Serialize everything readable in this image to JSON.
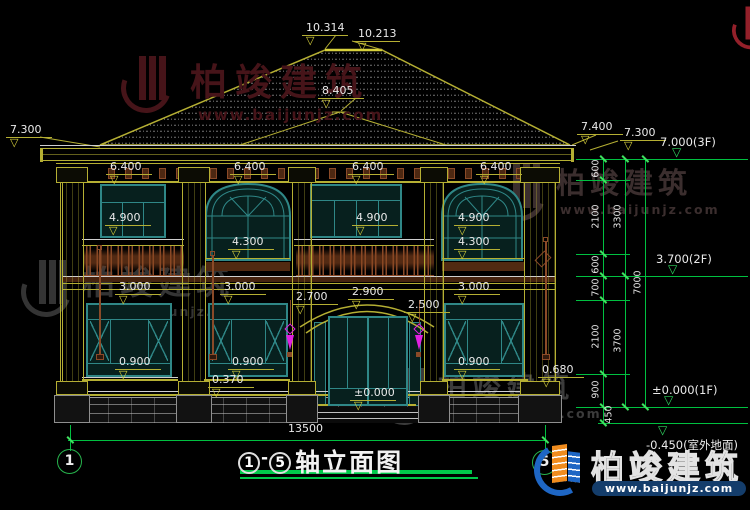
{
  "brand": {
    "name": "柏竣建筑",
    "url": "www.baijunjz.com"
  },
  "title": {
    "axis_from": "1",
    "dash": "-",
    "axis_to": "5",
    "text": "轴立面图"
  },
  "grid_bubbles": {
    "left": "1",
    "right": "5"
  },
  "overall_dim": {
    "text": "13500"
  },
  "icons": {
    "level_triangle": "▽"
  },
  "elevation_labels": [
    {
      "text": "10.314",
      "x": 302,
      "y": 22
    },
    {
      "text": "10.213",
      "x": 354,
      "y": 28
    },
    {
      "text": "8.405",
      "x": 318,
      "y": 85
    },
    {
      "text": "7.300",
      "x": 6,
      "y": 124
    },
    {
      "text": "7.400",
      "x": 577,
      "y": 121
    },
    {
      "text": "7.300",
      "x": 620,
      "y": 127
    },
    {
      "text": "6.400",
      "x": 106,
      "y": 161
    },
    {
      "text": "6.400",
      "x": 230,
      "y": 161
    },
    {
      "text": "6.400",
      "x": 348,
      "y": 161
    },
    {
      "text": "6.400",
      "x": 476,
      "y": 161
    },
    {
      "text": "4.900",
      "x": 105,
      "y": 212
    },
    {
      "text": "4.900",
      "x": 352,
      "y": 212
    },
    {
      "text": "4.900",
      "x": 454,
      "y": 212
    },
    {
      "text": "4.300",
      "x": 228,
      "y": 236
    },
    {
      "text": "4.300",
      "x": 454,
      "y": 236
    },
    {
      "text": "3.000",
      "x": 115,
      "y": 281
    },
    {
      "text": "3.000",
      "x": 220,
      "y": 281
    },
    {
      "text": "3.000",
      "x": 454,
      "y": 281
    },
    {
      "text": "2.700",
      "x": 292,
      "y": 291
    },
    {
      "text": "2.900",
      "x": 348,
      "y": 286
    },
    {
      "text": "2.500",
      "x": 404,
      "y": 299
    },
    {
      "text": "0.900",
      "x": 115,
      "y": 356
    },
    {
      "text": "0.900",
      "x": 228,
      "y": 356
    },
    {
      "text": "0.900",
      "x": 454,
      "y": 356
    },
    {
      "text": "0.370",
      "x": 208,
      "y": 374
    },
    {
      "text": "0.680",
      "x": 538,
      "y": 364
    },
    {
      "text": "±0.000",
      "x": 350,
      "y": 387
    }
  ],
  "right_levels": [
    {
      "text": "7.000(3F)",
      "x": 660,
      "y": 135,
      "line_y": 159,
      "below": false
    },
    {
      "text": "3.700(2F)",
      "x": 656,
      "y": 252,
      "line_y": 276,
      "below": false
    },
    {
      "text": "±0.000(1F)",
      "x": 652,
      "y": 383,
      "line_y": 407,
      "below": false
    },
    {
      "text": "-0.450(室外地面)",
      "x": 646,
      "y": 437,
      "line_y": 423,
      "below": true
    }
  ],
  "chain_labels": [
    {
      "text": "600",
      "x": 596,
      "y": 169
    },
    {
      "text": "2100",
      "x": 596,
      "y": 217
    },
    {
      "text": "600",
      "x": 596,
      "y": 265
    },
    {
      "text": "700",
      "x": 596,
      "y": 288
    },
    {
      "text": "2100",
      "x": 596,
      "y": 337
    },
    {
      "text": "900",
      "x": 596,
      "y": 390
    },
    {
      "text": "450",
      "x": 609,
      "y": 415
    },
    {
      "text": "3300",
      "x": 618,
      "y": 217
    },
    {
      "text": "3700",
      "x": 618,
      "y": 341
    },
    {
      "text": "7000",
      "x": 638,
      "y": 283
    }
  ],
  "colors": {
    "cad_yellow": "#b5af33",
    "dim_green": "#00c040",
    "window_teal": "#2f8787",
    "wood_brown": "#8a4a28",
    "lamp_magenta": "#e020e0",
    "logo_blue": "#1e66c4",
    "logo_orange": "#f08c1e"
  }
}
